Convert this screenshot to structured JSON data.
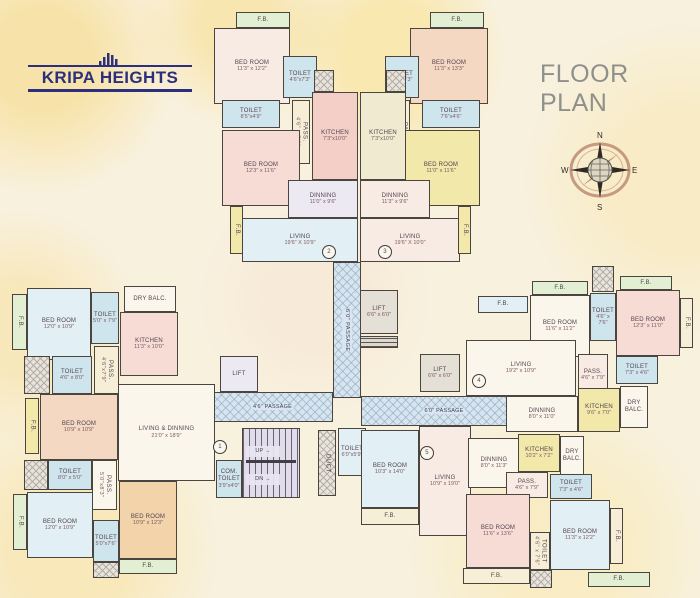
{
  "header": {
    "logo_text": "KRIPA HEIGHTS",
    "title": "FLOOR PLAN",
    "compass": {
      "n": "N",
      "e": "E",
      "s": "S",
      "w": "W"
    }
  },
  "palette": {
    "pinkA": "#f6dcd5",
    "pinkB": "#f3cfc8",
    "pinkW": "#f8ebe4",
    "peach": "#f4d8c2",
    "orange": "#f2d3aa",
    "blue": "#cfe5ee",
    "blueL": "#e2eff4",
    "yellow": "#f1e8a9",
    "cream": "#f6eed6",
    "creamY": "#f0ead0",
    "green": "#e3efd2",
    "white": "#faf6ec",
    "lav": "#ece9f3",
    "gray": "#e4e0d6"
  },
  "rooms": [
    {
      "id": "fb-top-left",
      "name": "F.B.",
      "x": 236,
      "y": 12,
      "w": 54,
      "h": 16,
      "fill": "green"
    },
    {
      "id": "bedroom-t2",
      "name": "BED ROOM",
      "dims": "11'3\" x 12'2\"",
      "x": 214,
      "y": 28,
      "w": 76,
      "h": 76,
      "fill": "pinkW"
    },
    {
      "id": "toilet-t2a",
      "name": "TOILET",
      "dims": "4'6\"x7'3\"",
      "x": 283,
      "y": 56,
      "w": 34,
      "h": 42,
      "fill": "blue"
    },
    {
      "id": "toilet-t2b",
      "name": "TOILET",
      "dims": "8'5\"x4'9\"",
      "x": 222,
      "y": 100,
      "w": 58,
      "h": 28,
      "fill": "blue"
    },
    {
      "id": "pass-t2",
      "name": "PASS.",
      "dims": "4'6\" x 7'9\"",
      "x": 292,
      "y": 100,
      "w": 18,
      "h": 64,
      "fill": "cream",
      "cls": "vert"
    },
    {
      "id": "bedroom-t2b",
      "name": "BED ROOM",
      "dims": "12'3\" x 11'6\"",
      "x": 222,
      "y": 130,
      "w": 78,
      "h": 76,
      "fill": "pinkA"
    },
    {
      "id": "kitchen-t2",
      "name": "KITCHEN",
      "dims": "7'3\"x10'0\"",
      "x": 312,
      "y": 92,
      "w": 46,
      "h": 88,
      "fill": "pinkB"
    },
    {
      "id": "dinning-t2",
      "name": "DINNING",
      "dims": "11'0\" x 9'6\"",
      "x": 288,
      "y": 180,
      "w": 70,
      "h": 38,
      "fill": "lav"
    },
    {
      "id": "living-t2",
      "name": "LIVING",
      "dims": "19'6\" X 10'9\"",
      "x": 242,
      "y": 218,
      "w": 116,
      "h": 44,
      "fill": "blueL"
    },
    {
      "id": "fb-top-right",
      "name": "F.B.",
      "x": 430,
      "y": 12,
      "w": 54,
      "h": 16,
      "fill": "green"
    },
    {
      "id": "bedroom-t3",
      "name": "BED ROOM",
      "dims": "11'3\" x 13'3\"",
      "x": 410,
      "y": 28,
      "w": 78,
      "h": 76,
      "fill": "peach"
    },
    {
      "id": "toilet-t3a",
      "name": "TOILET",
      "dims": "4'6\"x7'3\"",
      "x": 385,
      "y": 56,
      "w": 34,
      "h": 42,
      "fill": "blue"
    },
    {
      "id": "toilet-t3b",
      "name": "TOILET",
      "dims": "7'6\"x4'6\"",
      "x": 422,
      "y": 100,
      "w": 58,
      "h": 28,
      "fill": "blue"
    },
    {
      "id": "pass-t3",
      "name": "PASS.",
      "dims": "4'6\" x 8'0\"",
      "x": 392,
      "y": 100,
      "w": 18,
      "h": 64,
      "fill": "cream",
      "cls": "vert"
    },
    {
      "id": "bedroom-t3b",
      "name": "BED ROOM",
      "dims": "11'0\" x 11'6\"",
      "x": 402,
      "y": 130,
      "w": 78,
      "h": 76,
      "fill": "yellow"
    },
    {
      "id": "kitchen-t3",
      "name": "KITCHEN",
      "dims": "7'3\"x10'0\"",
      "x": 360,
      "y": 92,
      "w": 46,
      "h": 88,
      "fill": "creamY"
    },
    {
      "id": "dinning-t3",
      "name": "DINNING",
      "dims": "11'3\" x 9'6\"",
      "x": 360,
      "y": 180,
      "w": 70,
      "h": 38,
      "fill": "pinkW"
    },
    {
      "id": "living-t3",
      "name": "LIVING",
      "dims": "19'6\" X 10'0\"",
      "x": 360,
      "y": 218,
      "w": 100,
      "h": 44,
      "fill": "pinkW"
    },
    {
      "id": "fb-side-t2",
      "name": "F.B.",
      "x": 230,
      "y": 206,
      "w": 13,
      "h": 48,
      "fill": "yellow",
      "cls": "vert"
    },
    {
      "id": "fb-side-t3",
      "name": "F.B.",
      "x": 458,
      "y": 206,
      "w": 13,
      "h": 48,
      "fill": "yellow",
      "cls": "vert"
    },
    {
      "id": "duct-top-a",
      "x": 314,
      "y": 70,
      "w": 20,
      "h": 22,
      "cls": "duct"
    },
    {
      "id": "duct-top-b",
      "x": 386,
      "y": 70,
      "w": 20,
      "h": 22,
      "cls": "duct"
    },
    {
      "id": "passage-vertical",
      "name": "6'0\" PASSAGE",
      "x": 333,
      "y": 262,
      "w": 28,
      "h": 136,
      "cls": "hatch vert"
    },
    {
      "id": "passage-left",
      "name": "4'6\" PASSAGE",
      "x": 212,
      "y": 392,
      "w": 121,
      "h": 30,
      "cls": "hatch"
    },
    {
      "id": "passage-right",
      "name": "6'0\" PASSAGE",
      "x": 361,
      "y": 396,
      "w": 166,
      "h": 30,
      "cls": "hatch"
    },
    {
      "id": "lift-top",
      "name": "LIFT",
      "dims": "6'6\" x 6'0\"",
      "x": 360,
      "y": 290,
      "w": 38,
      "h": 44,
      "fill": "gray"
    },
    {
      "id": "lift-machine",
      "x": 360,
      "y": 336,
      "w": 38,
      "h": 12,
      "cls": "lines"
    },
    {
      "id": "lift-right",
      "name": "LIFT",
      "dims": "6'6\" x 6'0\"",
      "x": 420,
      "y": 354,
      "w": 40,
      "h": 38,
      "fill": "gray"
    },
    {
      "id": "lift-left",
      "name": "LIFT",
      "x": 220,
      "y": 356,
      "w": 38,
      "h": 36,
      "fill": "lav"
    },
    {
      "id": "stairs",
      "x": 242,
      "y": 428,
      "w": 58,
      "h": 70,
      "cls": "stairs"
    },
    {
      "id": "stairs-up-label",
      "name": "UP →",
      "x": 246,
      "y": 446,
      "w": 34,
      "h": 11,
      "cls": "plabel"
    },
    {
      "id": "stairs-dn-label",
      "name": "DN →",
      "x": 246,
      "y": 474,
      "w": 34,
      "h": 11,
      "cls": "plabel"
    },
    {
      "id": "com-toilet",
      "name": "COM. TOILET",
      "dims": "3'9\"x4'0\"",
      "x": 216,
      "y": 460,
      "w": 26,
      "h": 38,
      "fill": "blue"
    },
    {
      "id": "duct-stairs",
      "name": "DUCT",
      "x": 318,
      "y": 430,
      "w": 18,
      "h": 66,
      "cls": "duct vert"
    },
    {
      "id": "toilet-core",
      "name": "TOILET",
      "dims": "6'0\"x5'9\"",
      "x": 338,
      "y": 428,
      "w": 28,
      "h": 48,
      "fill": "blueL"
    },
    {
      "id": "fb-l1",
      "name": "F.B.",
      "x": 12,
      "y": 294,
      "w": 15,
      "h": 56,
      "fill": "green",
      "cls": "vert"
    },
    {
      "id": "bedroom-l1",
      "name": "BED ROOM",
      "dims": "12'0\" x 10'9\"",
      "x": 27,
      "y": 288,
      "w": 64,
      "h": 72,
      "fill": "blueL"
    },
    {
      "id": "toilet-l1",
      "name": "TOILET",
      "dims": "5'0\" x 7'9\"",
      "x": 91,
      "y": 292,
      "w": 28,
      "h": 52,
      "fill": "blue"
    },
    {
      "id": "drybalc-l1",
      "name": "DRY BALC.",
      "x": 124,
      "y": 286,
      "w": 52,
      "h": 26,
      "fill": "white"
    },
    {
      "id": "kitchen-l1",
      "name": "KITCHEN",
      "dims": "11'3\" x 10'0\"",
      "x": 120,
      "y": 312,
      "w": 58,
      "h": 64,
      "fill": "pinkA"
    },
    {
      "id": "pass-l1",
      "name": "PASS.",
      "dims": "4'6\"x7'9\"",
      "x": 94,
      "y": 346,
      "w": 25,
      "h": 48,
      "fill": "cream",
      "cls": "vert"
    },
    {
      "id": "duct-l1",
      "x": 24,
      "y": 356,
      "w": 26,
      "h": 38,
      "cls": "duct"
    },
    {
      "id": "toilet-l2",
      "name": "TOILET",
      "dims": "4'6\" x 8'0\"",
      "x": 52,
      "y": 356,
      "w": 40,
      "h": 38,
      "fill": "blue"
    },
    {
      "id": "fb-l2",
      "name": "F.B.",
      "x": 25,
      "y": 398,
      "w": 14,
      "h": 56,
      "fill": "yellow",
      "cls": "vert"
    },
    {
      "id": "bedroom-l2",
      "name": "BED ROOM",
      "dims": "10'9\" x 10'9\"",
      "x": 40,
      "y": 394,
      "w": 78,
      "h": 66,
      "fill": "peach"
    },
    {
      "id": "living-l1",
      "name": "LIVING & DINNING",
      "dims": "21'0\" x 18'9\"",
      "x": 118,
      "y": 384,
      "w": 97,
      "h": 97,
      "fill": "white"
    },
    {
      "id": "duct-l2",
      "x": 24,
      "y": 460,
      "w": 24,
      "h": 30,
      "cls": "duct"
    },
    {
      "id": "toilet-l3",
      "name": "TOILET",
      "dims": "8'0\" x 5'0\"",
      "x": 48,
      "y": 460,
      "w": 44,
      "h": 30,
      "fill": "blue"
    },
    {
      "id": "pass-l2",
      "name": "PASS.",
      "dims": "5'0\"x8'3\"",
      "x": 92,
      "y": 460,
      "w": 25,
      "h": 50,
      "fill": "white",
      "cls": "vert"
    },
    {
      "id": "fb-l3",
      "name": "F.B.",
      "x": 13,
      "y": 494,
      "w": 14,
      "h": 56,
      "fill": "green",
      "cls": "vert"
    },
    {
      "id": "bedroom-l3",
      "name": "BED ROOM",
      "dims": "12'0\" x 10'9\"",
      "x": 27,
      "y": 492,
      "w": 66,
      "h": 66,
      "fill": "blueL"
    },
    {
      "id": "toilet-l4",
      "name": "TOILET",
      "dims": "5'0\"x7'6\"",
      "x": 93,
      "y": 520,
      "w": 26,
      "h": 42,
      "fill": "blue"
    },
    {
      "id": "bedroom-l4",
      "name": "BED ROOM",
      "dims": "10'9\" x 12'3\"",
      "x": 119,
      "y": 481,
      "w": 58,
      "h": 78,
      "fill": "orange"
    },
    {
      "id": "fb-l4",
      "name": "F.B.",
      "x": 119,
      "y": 559,
      "w": 58,
      "h": 15,
      "fill": "green"
    },
    {
      "id": "duct-l3",
      "x": 93,
      "y": 562,
      "w": 26,
      "h": 16,
      "cls": "duct"
    },
    {
      "id": "fb-r1",
      "name": "F.B.",
      "x": 478,
      "y": 296,
      "w": 50,
      "h": 17,
      "fill": "blueL"
    },
    {
      "id": "fb-r2",
      "name": "F.B.",
      "x": 532,
      "y": 281,
      "w": 56,
      "h": 14,
      "fill": "green"
    },
    {
      "id": "fb-r3",
      "name": "F.B.",
      "x": 620,
      "y": 276,
      "w": 52,
      "h": 14,
      "fill": "green"
    },
    {
      "id": "duct-r1",
      "x": 592,
      "y": 266,
      "w": 22,
      "h": 26,
      "cls": "duct"
    },
    {
      "id": "bedroom-r1",
      "name": "BED ROOM",
      "dims": "11'6\" x 11'2\"",
      "x": 530,
      "y": 295,
      "w": 60,
      "h": 62,
      "fill": "white"
    },
    {
      "id": "toilet-r1",
      "name": "TOILET",
      "dims": "4'6\" x 7'6\"",
      "x": 590,
      "y": 293,
      "w": 26,
      "h": 48,
      "fill": "blue"
    },
    {
      "id": "bedroom-r2",
      "name": "BED ROOM",
      "dims": "12'3\" x 11'0\"",
      "x": 616,
      "y": 290,
      "w": 64,
      "h": 66,
      "fill": "pinkA"
    },
    {
      "id": "fb-r4",
      "name": "F.B.",
      "x": 680,
      "y": 298,
      "w": 13,
      "h": 50,
      "fill": "cream",
      "cls": "vert"
    },
    {
      "id": "living-r1",
      "name": "LIVING",
      "dims": "19'2\" x 10'9\"",
      "x": 466,
      "y": 340,
      "w": 110,
      "h": 56,
      "fill": "white"
    },
    {
      "id": "pass-r1",
      "name": "PASS.",
      "dims": "4'6\" x 7'9\"",
      "x": 578,
      "y": 354,
      "w": 30,
      "h": 42,
      "fill": "pinkW"
    },
    {
      "id": "toilet-r2",
      "name": "TOILET",
      "dims": "7'3\" x 4'6\"",
      "x": 616,
      "y": 356,
      "w": 42,
      "h": 28,
      "fill": "blue"
    },
    {
      "id": "dinning-r1",
      "name": "DINNING",
      "dims": "8'0\" x 11'0\"",
      "x": 506,
      "y": 396,
      "w": 72,
      "h": 36,
      "fill": "white"
    },
    {
      "id": "kitchen-r1",
      "name": "KITCHEN",
      "dims": "9'6\" x 7'0\"",
      "x": 578,
      "y": 388,
      "w": 42,
      "h": 44,
      "fill": "yellow"
    },
    {
      "id": "drybalc-r1",
      "name": "DRY BALC.",
      "x": 620,
      "y": 386,
      "w": 28,
      "h": 42,
      "fill": "white"
    },
    {
      "id": "bedroom-u5a",
      "name": "BED ROOM",
      "dims": "10'3\" x 14'0\"",
      "x": 361,
      "y": 430,
      "w": 58,
      "h": 78,
      "fill": "blueL"
    },
    {
      "id": "fb-u5a",
      "name": "F.B.",
      "x": 361,
      "y": 508,
      "w": 58,
      "h": 17,
      "fill": "cream"
    },
    {
      "id": "living-u5",
      "name": "LIVING",
      "dims": "10'9\" x 19'0\"",
      "x": 419,
      "y": 426,
      "w": 52,
      "h": 110,
      "fill": "pinkW"
    },
    {
      "id": "dinning-u5",
      "name": "DINNING",
      "dims": "8'0\" x 11'3\"",
      "x": 468,
      "y": 438,
      "w": 52,
      "h": 50,
      "fill": "white"
    },
    {
      "id": "kitchen-u5",
      "name": "KITCHEN",
      "dims": "10'2\" x 7'2\"",
      "x": 518,
      "y": 434,
      "w": 42,
      "h": 38,
      "fill": "yellow"
    },
    {
      "id": "drybalc-u5",
      "name": "DRY BALC.",
      "x": 560,
      "y": 436,
      "w": 24,
      "h": 40,
      "fill": "white"
    },
    {
      "id": "pass-u5",
      "name": "PASS.",
      "dims": "4'6\" x 7'9\"",
      "x": 506,
      "y": 472,
      "w": 42,
      "h": 26,
      "fill": "pinkW"
    },
    {
      "id": "toilet-u5a",
      "name": "TOILET",
      "dims": "7'3\" x 4'6\"",
      "x": 550,
      "y": 474,
      "w": 42,
      "h": 25,
      "fill": "blue"
    },
    {
      "id": "bedroom-u5b",
      "name": "BED ROOM",
      "dims": "11'6\" x 13'6\"",
      "x": 466,
      "y": 494,
      "w": 64,
      "h": 74,
      "fill": "pinkA"
    },
    {
      "id": "toilet-u5b",
      "name": "TOILET",
      "dims": "4'6\" x 7'6\"",
      "x": 530,
      "y": 532,
      "w": 20,
      "h": 38,
      "fill": "cream",
      "cls": "vert"
    },
    {
      "id": "bedroom-u5c",
      "name": "BED ROOM",
      "dims": "11'3\" x 12'2\"",
      "x": 550,
      "y": 500,
      "w": 60,
      "h": 70,
      "fill": "blueL"
    },
    {
      "id": "fb-u5b",
      "name": "F.B.",
      "x": 610,
      "y": 508,
      "w": 13,
      "h": 56,
      "fill": "cream",
      "cls": "vert"
    },
    {
      "id": "fb-u5c",
      "name": "F.B.",
      "x": 463,
      "y": 568,
      "w": 67,
      "h": 16,
      "fill": "cream"
    },
    {
      "id": "duct-u5",
      "x": 530,
      "y": 570,
      "w": 22,
      "h": 18,
      "cls": "duct"
    },
    {
      "id": "fb-u5d",
      "name": "F.B.",
      "x": 588,
      "y": 572,
      "w": 62,
      "h": 15,
      "fill": "green"
    },
    {
      "id": "unit-1-badge",
      "name": "1",
      "x": 213,
      "y": 440,
      "w": 14,
      "h": 14,
      "cls": "badge"
    },
    {
      "id": "unit-2-badge",
      "name": "2",
      "x": 322,
      "y": 245,
      "w": 14,
      "h": 14,
      "cls": "badge"
    },
    {
      "id": "unit-3-badge",
      "name": "3",
      "x": 378,
      "y": 245,
      "w": 14,
      "h": 14,
      "cls": "badge"
    },
    {
      "id": "unit-4-badge",
      "name": "4",
      "x": 472,
      "y": 374,
      "w": 14,
      "h": 14,
      "cls": "badge"
    },
    {
      "id": "unit-5-badge",
      "name": "5",
      "x": 420,
      "y": 446,
      "w": 14,
      "h": 14,
      "cls": "badge"
    }
  ]
}
